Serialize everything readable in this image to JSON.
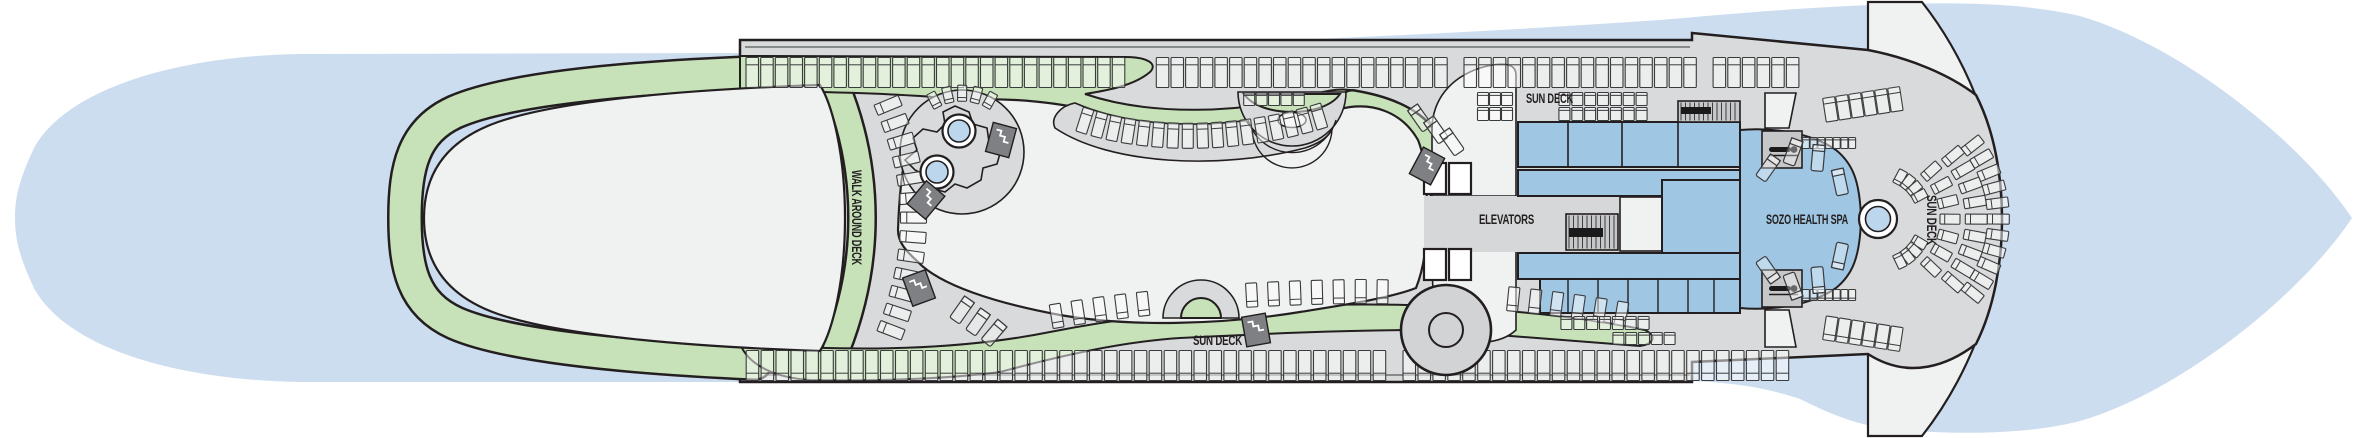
{
  "diagram": {
    "type": "cruise-ship-deck-plan",
    "deck_theme": "sun deck / spa deck top view",
    "labels": {
      "walk_around_deck": "WALK AROUND DECK",
      "sun_deck_top": "SUN DECK",
      "sun_deck_bottom": "SUN DECK",
      "sun_deck_bow": "SUN DECK",
      "elevators": "ELEVATORS",
      "spa": "SOZO HEALTH SPA"
    },
    "colors": {
      "water": "#cdddf0",
      "deck": "#d9dadb",
      "deck_dark": "#c6c7c9",
      "track_green": "#c7e1b8",
      "open_white": "#f0f1f1",
      "cabin_blue": "#9fc6e3",
      "pool_blue": "#bcd6ee",
      "stairs_dark": "#7e8083",
      "outline": "#231f20"
    },
    "features": [
      {
        "name": "walk-around-track"
      },
      {
        "name": "hot-tub-icon",
        "count": 2
      },
      {
        "name": "pool-icon",
        "count": 1
      },
      {
        "name": "funnel-icon",
        "count": 1
      },
      {
        "name": "stairs-icon",
        "count": 5
      },
      {
        "name": "staircase-block",
        "count": 2
      },
      {
        "name": "massage-table-icon",
        "count": 2
      },
      {
        "name": "elevator-car",
        "count": 4
      },
      {
        "name": "deck-chair-rows"
      },
      {
        "name": "spa-loungers"
      }
    ]
  }
}
